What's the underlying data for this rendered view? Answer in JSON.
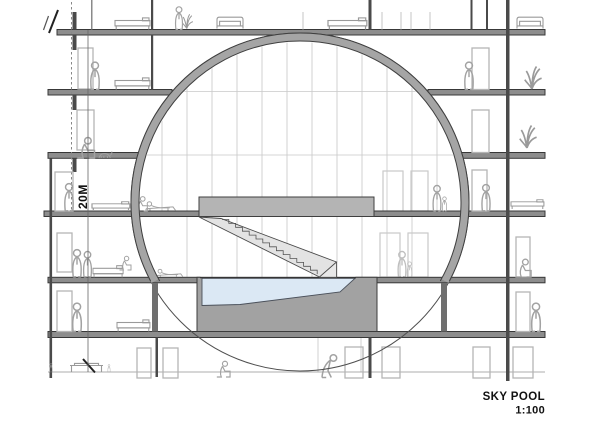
{
  "drawing": {
    "title": "SKY POOL",
    "scale": "1:100",
    "dimension_label": "20M"
  },
  "colors": {
    "background": "#ffffff",
    "slab_gray": "#8d8d8d",
    "ring_gray": "#a5a5a5",
    "basin_gray": "#a2a2a2",
    "platform_gray": "#b4b4b4",
    "stair_gray": "#e4e4e4",
    "water_blue": "#dbe8f4",
    "line_dark": "#3a3a3a"
  }
}
